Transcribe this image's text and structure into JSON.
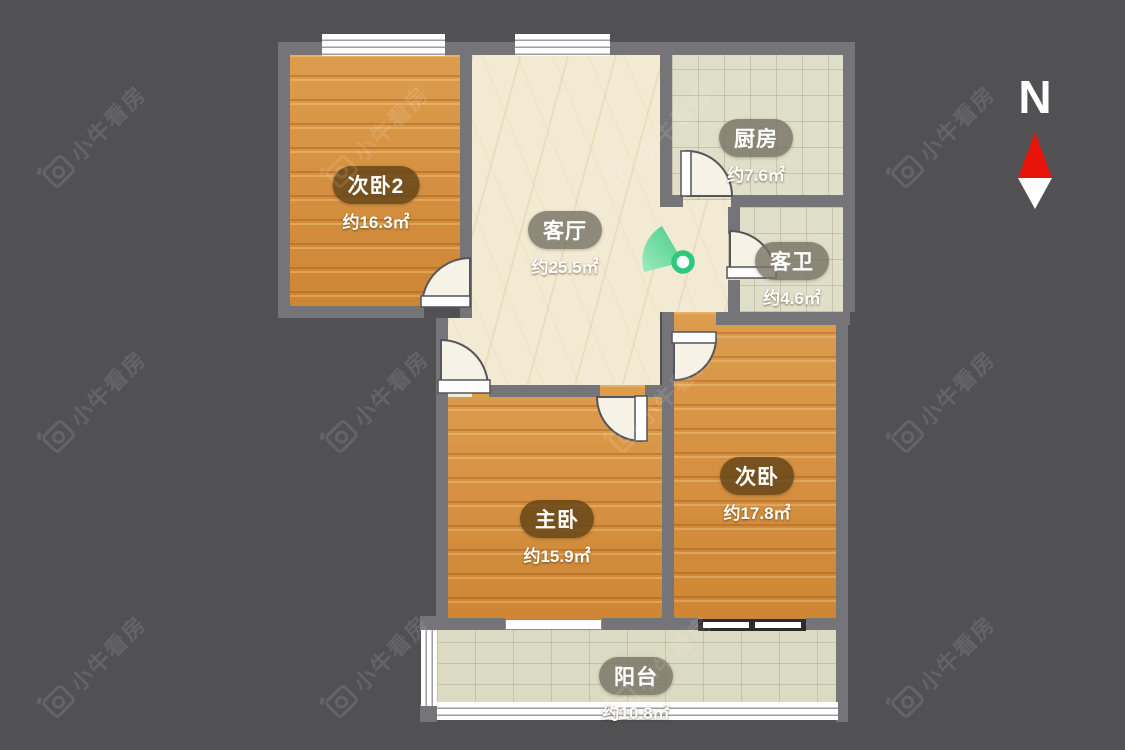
{
  "watermark": {
    "text": "小牛看房"
  },
  "compass": {
    "label": "N"
  },
  "rooms": [
    {
      "name": "次卧2",
      "area": "约16.3㎡"
    },
    {
      "name": "客厅",
      "area": "约25.5㎡"
    },
    {
      "name": "厨房",
      "area": "约7.6㎡"
    },
    {
      "name": "客卫",
      "area": "约4.6㎡"
    },
    {
      "name": "主卧",
      "area": "约15.9㎡"
    },
    {
      "name": "次卧",
      "area": "约17.8㎡"
    },
    {
      "name": "阳台",
      "area": "约10.8㎡"
    }
  ],
  "colors": {
    "background": "#515154",
    "wall": "#757579",
    "wood_floor": "#d8913f",
    "marble_floor": "#f3ead3",
    "tile_floor": "#e0dfc9",
    "door_leaf": "#f7f2e6",
    "entrance_green": "#2fc97e",
    "compass_red": "#e91208"
  }
}
